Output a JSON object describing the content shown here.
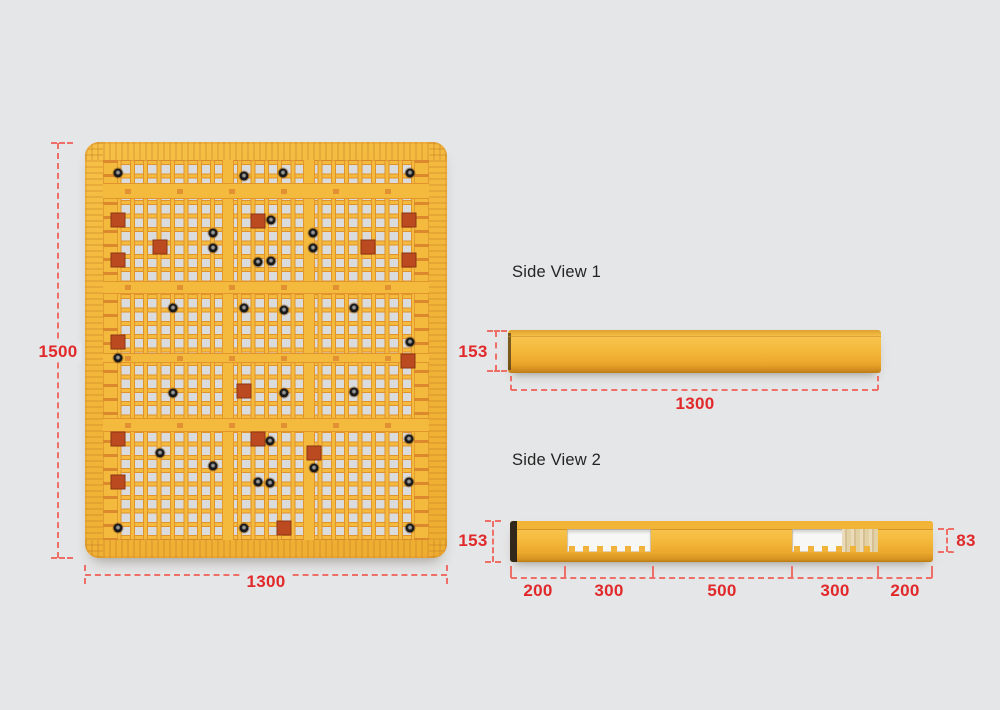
{
  "colors": {
    "background": "#e5e6e7",
    "pallet_yellow": "#f2b63a",
    "pallet_shadow_orange": "#e2952c",
    "dim_red": "#e1292b",
    "dash_red": "#ee6f68",
    "hole_gray": "#d9dbdd",
    "title_text": "#242424"
  },
  "top_view": {
    "height_label": "1500",
    "width_label": "1300",
    "dots": [
      {
        "x": 33,
        "y": 31
      },
      {
        "x": 159,
        "y": 34
      },
      {
        "x": 198,
        "y": 31
      },
      {
        "x": 325,
        "y": 31
      },
      {
        "x": 33,
        "y": 78,
        "p": 1
      },
      {
        "x": 173,
        "y": 79,
        "p": 1
      },
      {
        "x": 186,
        "y": 78
      },
      {
        "x": 324,
        "y": 78,
        "p": 1
      },
      {
        "x": 128,
        "y": 91
      },
      {
        "x": 228,
        "y": 91
      },
      {
        "x": 75,
        "y": 105,
        "p": 1
      },
      {
        "x": 128,
        "y": 106
      },
      {
        "x": 228,
        "y": 106
      },
      {
        "x": 283,
        "y": 105,
        "p": 1
      },
      {
        "x": 33,
        "y": 118,
        "p": 1
      },
      {
        "x": 173,
        "y": 120
      },
      {
        "x": 186,
        "y": 119
      },
      {
        "x": 324,
        "y": 118,
        "p": 1
      },
      {
        "x": 88,
        "y": 166
      },
      {
        "x": 159,
        "y": 166
      },
      {
        "x": 199,
        "y": 168
      },
      {
        "x": 269,
        "y": 166
      },
      {
        "x": 33,
        "y": 200,
        "p": 1
      },
      {
        "x": 325,
        "y": 200
      },
      {
        "x": 33,
        "y": 216
      },
      {
        "x": 323,
        "y": 219,
        "p": 1
      },
      {
        "x": 88,
        "y": 251
      },
      {
        "x": 159,
        "y": 249,
        "p": 1
      },
      {
        "x": 199,
        "y": 251
      },
      {
        "x": 269,
        "y": 250
      },
      {
        "x": 33,
        "y": 297,
        "p": 1
      },
      {
        "x": 173,
        "y": 297,
        "p": 1
      },
      {
        "x": 185,
        "y": 299
      },
      {
        "x": 324,
        "y": 297
      },
      {
        "x": 75,
        "y": 311
      },
      {
        "x": 229,
        "y": 311,
        "p": 1
      },
      {
        "x": 128,
        "y": 324
      },
      {
        "x": 229,
        "y": 326
      },
      {
        "x": 33,
        "y": 340,
        "p": 1
      },
      {
        "x": 173,
        "y": 340
      },
      {
        "x": 185,
        "y": 341
      },
      {
        "x": 324,
        "y": 340
      },
      {
        "x": 33,
        "y": 386
      },
      {
        "x": 159,
        "y": 386
      },
      {
        "x": 199,
        "y": 386,
        "p": 1
      },
      {
        "x": 325,
        "y": 386
      }
    ]
  },
  "side_view_1": {
    "title": "Side View 1",
    "height_label": "153",
    "length_label": "1300"
  },
  "side_view_2": {
    "title": "Side View 2",
    "height_label": "153",
    "fork_height_label": "83",
    "segments": [
      "200",
      "300",
      "500",
      "300",
      "200"
    ]
  }
}
